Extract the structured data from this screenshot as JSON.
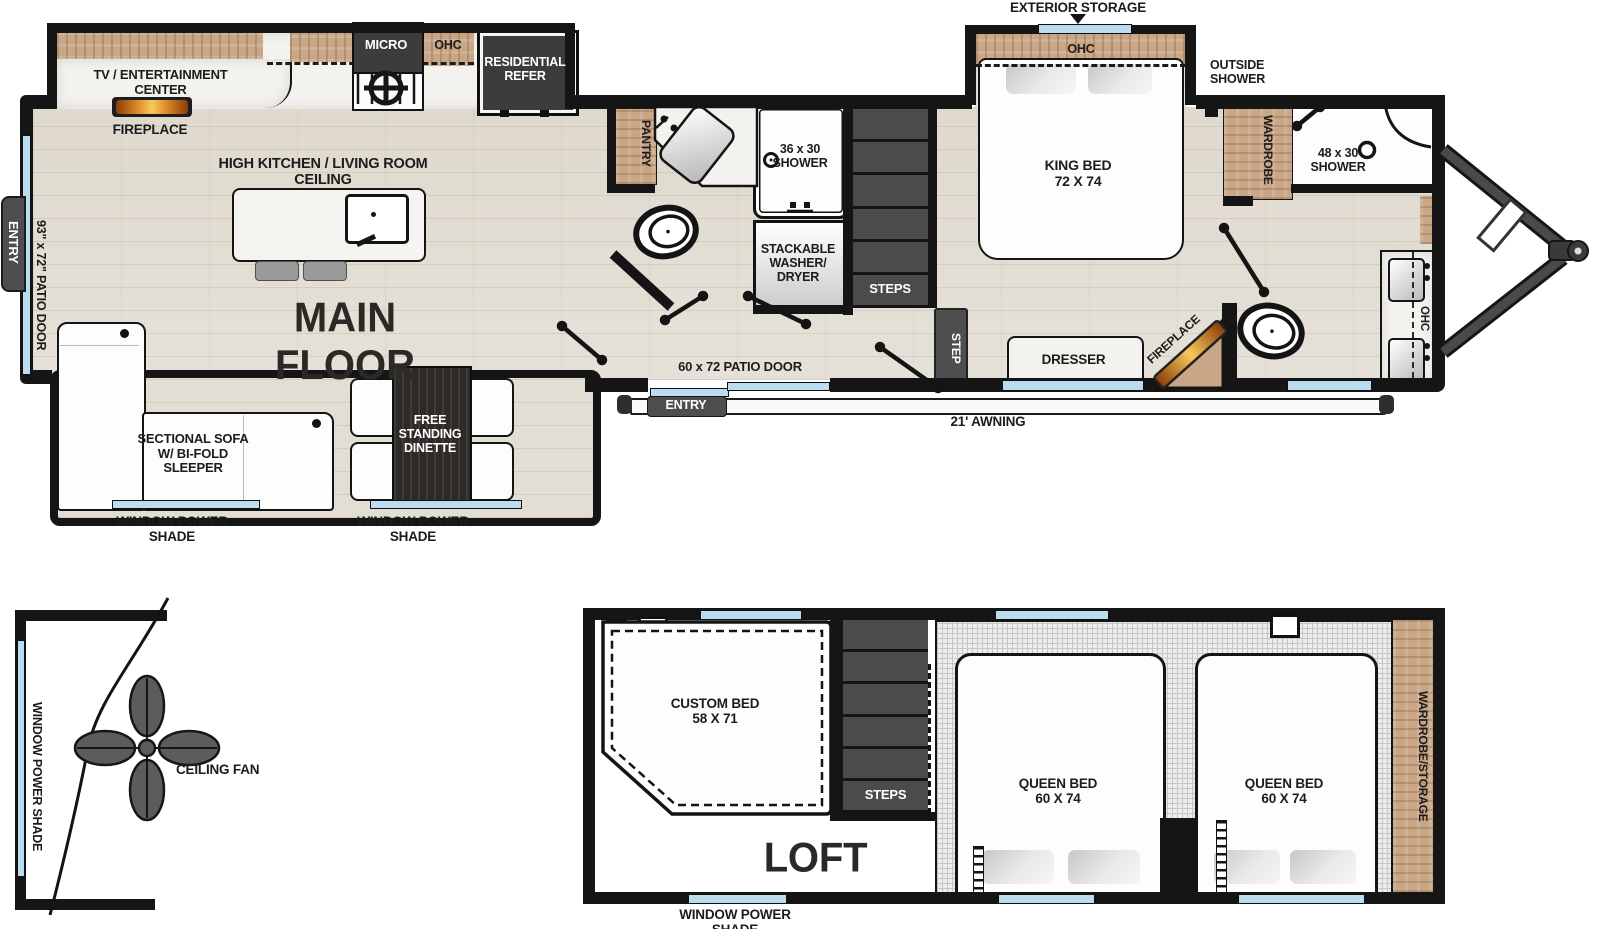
{
  "main_floor": {
    "title": "MAIN FLOOR",
    "exterior_storage": "EXTERIOR STORAGE",
    "high_ceiling": "HIGH KITCHEN / LIVING ROOM CEILING",
    "kitchen": {
      "tv": "TV / ENTERTAINMENT\nCENTER",
      "fireplace": "FIREPLACE",
      "micro": "MICRO",
      "ohc": "OHC",
      "refer": "RESIDENTIAL\nREFER"
    },
    "left": {
      "entry": "ENTRY",
      "patio_door": "93\" x 72\" PATIO DOOR"
    },
    "living": {
      "sofa": "SECTIONAL SOFA\nW/ BI-FOLD\nSLEEPER",
      "dinette": "FREE\nSTANDING\nDINETTE",
      "shade_left": "WINDOW POWER SHADE",
      "shade_right": "WINDOW POWER SHADE"
    },
    "bath": {
      "pantry": "PANTRY",
      "shower": "36 x 30\nSHOWER",
      "washer": "STACKABLE\nWASHER/\nDRYER"
    },
    "hall": {
      "steps": "STEPS",
      "step": "STEP",
      "patio_door": "60 x 72 PATIO DOOR",
      "entry": "ENTRY",
      "awning": "21' AWNING"
    },
    "bedroom": {
      "king_bed": "KING BED\n72 X 74",
      "ohc": "OHC",
      "dresser": "DRESSER",
      "fireplace": "FIREPLACE"
    },
    "front": {
      "outside_shower": "OUTSIDE\nSHOWER",
      "wardrobe": "WARDROBE",
      "shower": "48 x 30\nSHOWER",
      "ohc": "OHC"
    }
  },
  "fan": {
    "label": "CEILING FAN",
    "shade": "WINDOW POWER SHADE"
  },
  "loft": {
    "title": "LOFT",
    "custom_bed": "CUSTOM BED\n58 X 71",
    "steps": "STEPS",
    "queen_left": "QUEEN BED\n60 X 74",
    "queen_right": "QUEEN BED\n60 X 74",
    "wardrobe": "WARDROBE/STORAGE",
    "shade": "WINDOW POWER SHADE"
  },
  "colors": {
    "wall": "#151515",
    "wood": "#c9a685",
    "floor": "#e3ded4",
    "window": "#bcdcf0",
    "appliance_dark": "#3c3c3c",
    "flame": "#e08a2c"
  }
}
